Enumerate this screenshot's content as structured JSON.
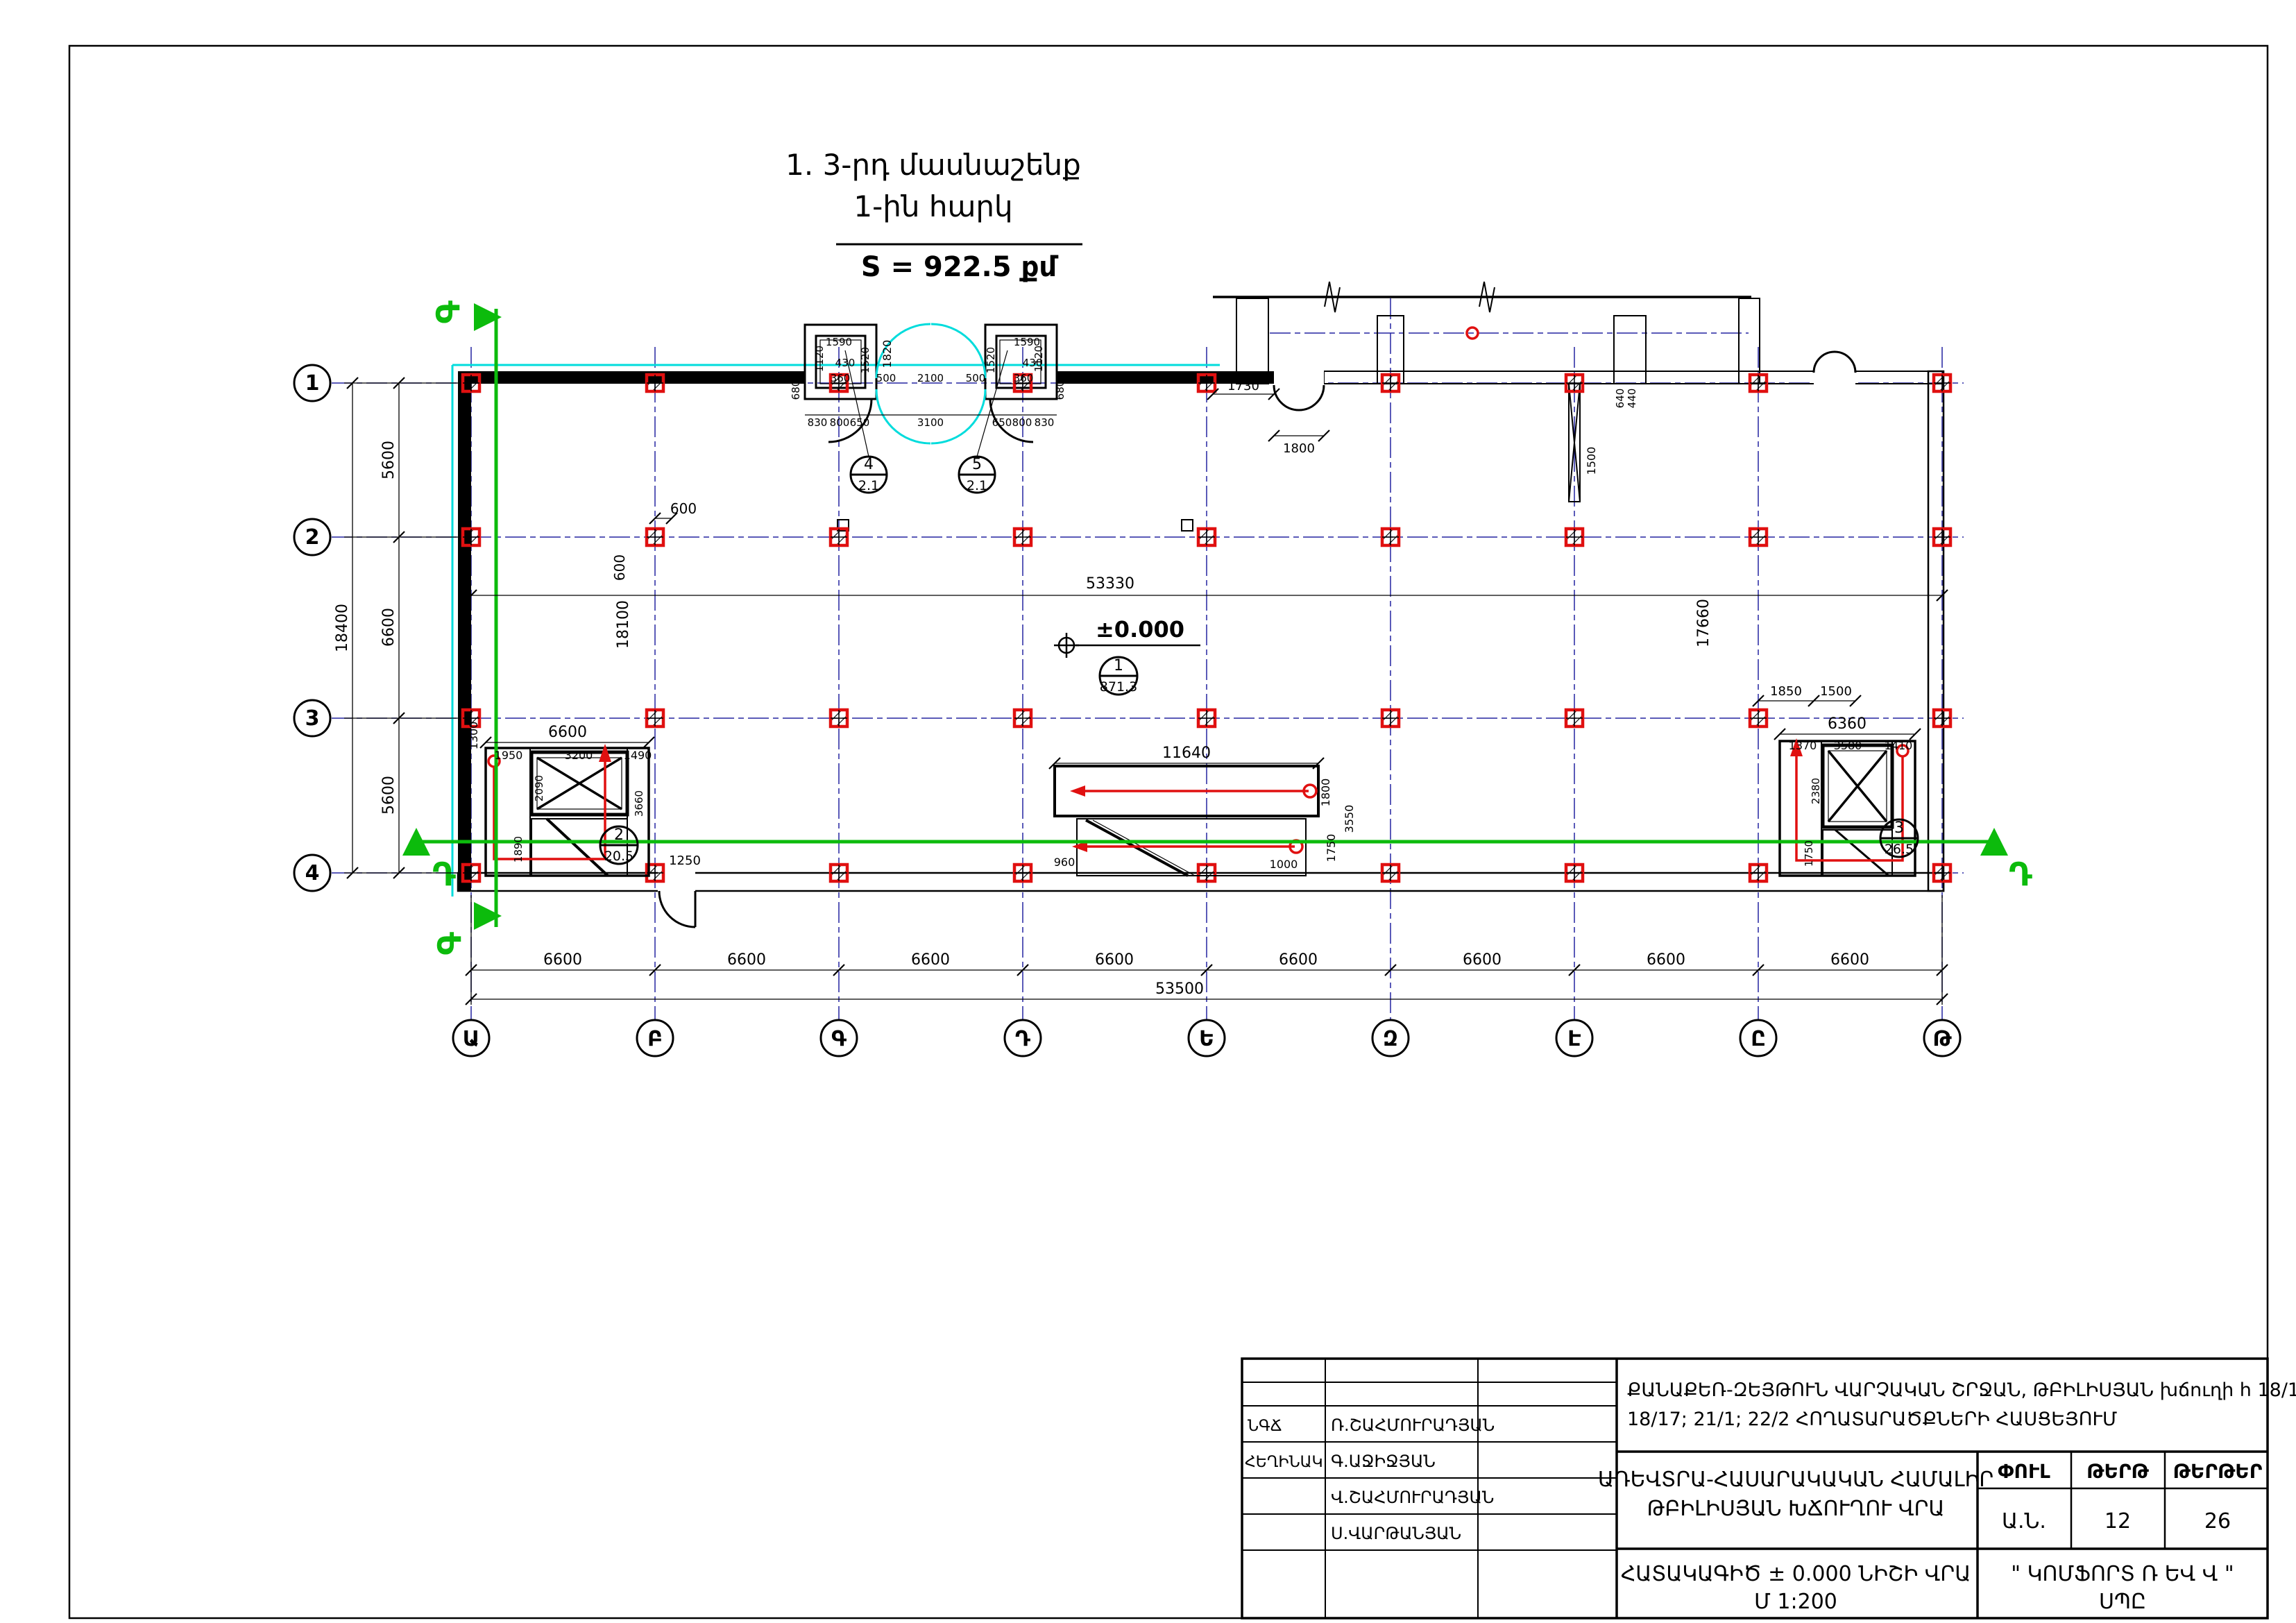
{
  "title": {
    "line1": "1. 3-րդ մասնաշենք",
    "line2": "1-ին հարկ",
    "area": "S = 922.5 քմ"
  },
  "axes": {
    "rows": [
      "1",
      "2",
      "3",
      "4"
    ],
    "cols": [
      "Ա",
      "Բ",
      "Գ",
      "Դ",
      "Ե",
      "Զ",
      "Է",
      "Ը",
      "Թ"
    ]
  },
  "sections": {
    "horizontal": "Դ",
    "vertical": "Գ"
  },
  "level": {
    "value": "±0.000"
  },
  "rooms": [
    {
      "num": "1",
      "area": "871.3"
    },
    {
      "num": "2",
      "area": "20.5"
    },
    {
      "num": "3",
      "area": "26.5"
    },
    {
      "num": "4",
      "area": "2.1"
    },
    {
      "num": "5",
      "area": "2.1"
    }
  ],
  "dims": {
    "left_total": "18400",
    "left_chain": [
      "5600",
      "6600",
      "5600"
    ],
    "bottom_chain": [
      "6600",
      "6600",
      "6600",
      "6600",
      "6600",
      "6600",
      "6600",
      "6600"
    ],
    "bottom_total": "53500",
    "inner_top": "53330",
    "inner_left": "18100",
    "inner_right": "17660",
    "col_h": "600",
    "col_v": "600",
    "entrance_chain": [
      "830",
      "800",
      "650",
      "3100",
      "650",
      "800",
      "830"
    ],
    "entrance_top": [
      "500",
      "2100",
      "500"
    ],
    "entrance_h": "1820",
    "entrance_side_l": "680",
    "entrance_side_r": "680",
    "shaft_l": {
      "w": "1590",
      "d": "1520",
      "d2": "1120",
      "a": "430",
      "b": "360"
    },
    "shaft_r": {
      "w": "1590",
      "d": "1520",
      "d2": "1120",
      "a": "430",
      "b": "360"
    },
    "canopy_l": "1730",
    "door_top": "1800",
    "p1": "640",
    "p2": "440",
    "brace": "1500",
    "cstair": {
      "len": "11640",
      "w1": "1800",
      "w2": "1750",
      "w": "3550",
      "e1": "960",
      "e2": "1000"
    },
    "lstair": {
      "top": "6600",
      "c1": "1950",
      "c2": "3200",
      "c3": "1490",
      "s": "1300",
      "v1": "2090",
      "v2": "3660",
      "v3": "1890",
      "door": "1250"
    },
    "rstair": {
      "top": "6360",
      "c1": "1370",
      "c2": "3580",
      "c3": "1410",
      "d1": "1850",
      "d2": "1500",
      "v1": "2380",
      "v2": "1750"
    }
  },
  "titleblock": {
    "project1": "ՔԱՆԱՔԵՌ-ԶԵՅԹՈՒՆ ՎԱՐՉԱԿԱՆ ՇՐՋԱՆ, ԹԲԻԼԻՍՅԱՆ խճուղի h 18/16;",
    "project2": "18/17; 21/1; 22/2 ՀՈՂԱՏԱՐԱԾՔՆԵՐԻ ՀԱՍՑԵՅՈՒՄ",
    "object1": "ԱՌԵՎՏՐԱ-ՀԱՍԱՐԱԿԱԿԱՆ ՀԱՄԱԼԻՐ",
    "object2": "ԹԲԻԼԻՍՅԱՆ ԽՃՈՒՂՈՒ ՎՐԱ",
    "stage_label": "ՓՈՒԼ",
    "sheet_label": "ԹԵՐԹ",
    "sheets_label": "ԹԵՐԹԵՐ",
    "stage": "Ա.Ն.",
    "sheet_no": "12",
    "sheets_total": "26",
    "sheet_title": "ՀԱՏԱԿԱԳԻԾ ± 0.000 ՆԻՇԻ ՎՐԱ",
    "scale": "Մ 1:200",
    "company": "\" ԿՈՄՖՈՐՏ Ռ ԵՎ Վ \"",
    "company2": "ՍՊԸ",
    "roles": [
      {
        "role": "ՆԳՃ",
        "name": "Ռ.ՇԱՀՄՈՒՐԱԴՅԱՆ"
      },
      {
        "role": "ՀԵՂԻՆԱԿ",
        "name": "Գ.ԱՋԻՋՅԱՆ"
      },
      {
        "role": "",
        "name": "Վ.ՇԱՀՄՈՒՐԱԴՅԱՆ"
      },
      {
        "role": "",
        "name": "Ս.ՎԱՐԹԱՆՅԱՆ"
      }
    ]
  }
}
